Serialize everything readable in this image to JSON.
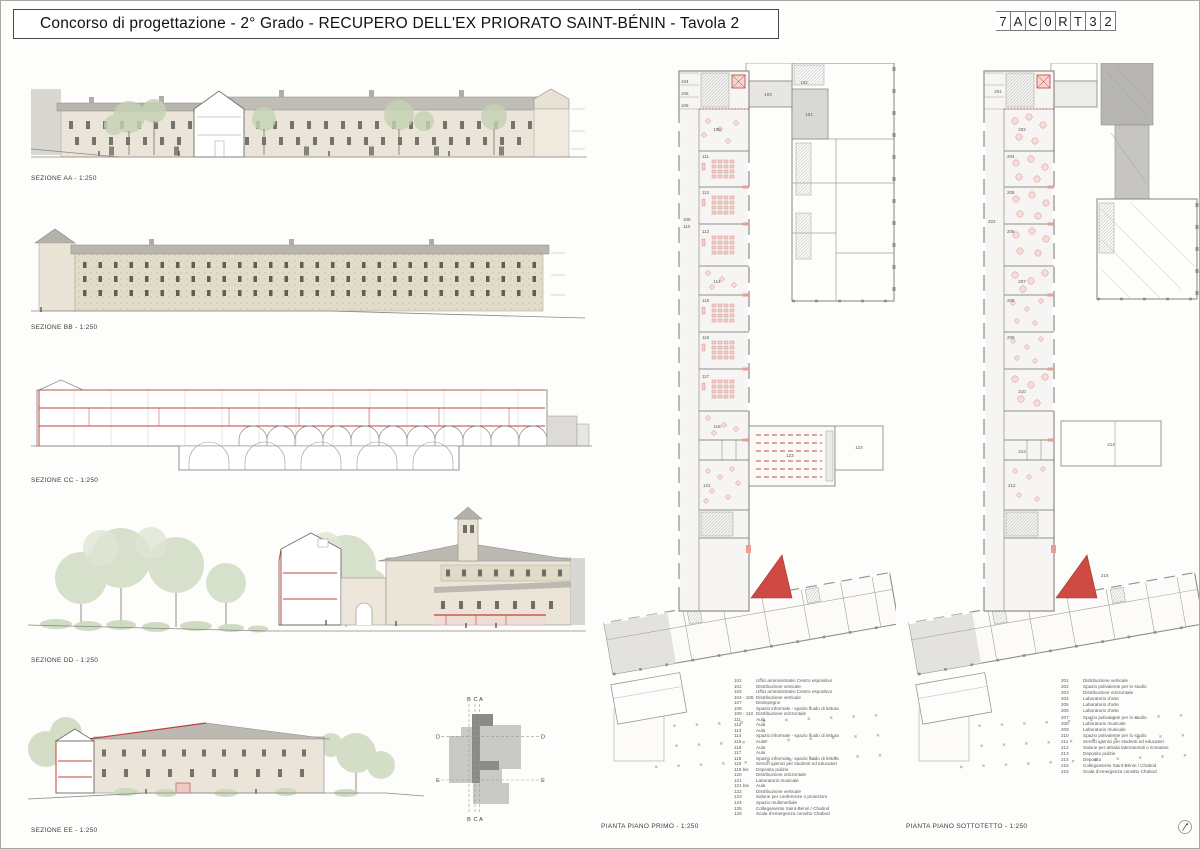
{
  "header": {
    "title": "Concorso di progettazione - 2° Grado - RECUPERO DELL'EX PRIORATO SAINT-BÉNIN - Tavola 2",
    "code_cells": [
      "7",
      "A",
      "C",
      "0",
      "R",
      "T",
      "3",
      "2"
    ]
  },
  "sections": [
    {
      "id": "AA",
      "label": "SEZIONE AA - 1:250"
    },
    {
      "id": "BB",
      "label": "SEZIONE BB - 1:250"
    },
    {
      "id": "CC",
      "label": "SEZIONE CC - 1:250"
    },
    {
      "id": "DD",
      "label": "SEZIONE DD - 1:250"
    },
    {
      "id": "EE",
      "label": "SEZIONE EE - 1:250"
    }
  ],
  "plans": [
    {
      "label": "PIANTA PIANO PRIMO - 1:250",
      "rooms": {
        "r101": "101",
        "r102": "102",
        "r103": "103",
        "r104": "104",
        "r105": "105",
        "r106": "106",
        "r108": "108",
        "r109": "109",
        "r110": "110",
        "r111": "111",
        "r112": "112",
        "r113": "113",
        "r114": "114",
        "r115": "115",
        "r116": "116",
        "r117": "117",
        "r118": "118",
        "r121": "121",
        "r123": "123",
        "r124": "124"
      }
    },
    {
      "label": "PIANTA PIANO SOTTOTETTO - 1:250",
      "rooms": {
        "r201": "201",
        "r202": "202",
        "r203": "203",
        "r204": "204",
        "r205": "205",
        "r206": "206",
        "r207": "207",
        "r208": "208",
        "r209": "209",
        "r210": "210",
        "r212": "212",
        "r213": "213",
        "r214": "214",
        "r215": "215"
      }
    }
  ],
  "key_plan": {
    "top_labels": [
      "B",
      "C",
      "A"
    ],
    "bottom_labels": [
      "B",
      "C",
      "A"
    ],
    "side_labels": {
      "d_left": "D",
      "d_right": "D",
      "e_left": "E",
      "e_right": "E"
    }
  },
  "legend_piano_primo": {
    "items": [
      {
        "code": "101",
        "label": "Uffici amministrativi Centro espositivo"
      },
      {
        "code": "102",
        "label": "Distribuzione verticale"
      },
      {
        "code": "103",
        "label": "Uffici amministrativi Centro espositivo"
      },
      {
        "code": "104 - 106",
        "label": "Distribuzione verticale"
      },
      {
        "code": "107",
        "label": "Disimpegno"
      },
      {
        "code": "108",
        "label": "Spazio informale - spazio fluido di lettura"
      },
      {
        "code": "109 - 110",
        "label": "Distribuzione orizzontale"
      },
      {
        "code": "111",
        "label": "Aula"
      },
      {
        "code": "112",
        "label": "Aula"
      },
      {
        "code": "113",
        "label": "Aula"
      },
      {
        "code": "114",
        "label": "Spazio informale - spazio fluido di lettura"
      },
      {
        "code": "115",
        "label": "Aula"
      },
      {
        "code": "116",
        "label": "Aula"
      },
      {
        "code": "117",
        "label": "Aula"
      },
      {
        "code": "118",
        "label": "Spazio informale - spazio fluido di lettura"
      },
      {
        "code": "119",
        "label": "Servizi igienici per studenti ed educatori"
      },
      {
        "code": "119 bis",
        "label": "Deposito pulizie"
      },
      {
        "code": "120",
        "label": "Distribuzione orizzontale"
      },
      {
        "code": "121",
        "label": "Laboratorio musicale"
      },
      {
        "code": "121 bis",
        "label": "Aula"
      },
      {
        "code": "122",
        "label": "Distribuzione verticale"
      },
      {
        "code": "123",
        "label": "Salone per conferenze o proiezioni"
      },
      {
        "code": "124",
        "label": "Spazio multimediale"
      },
      {
        "code": "125",
        "label": "Collegamento Saint-Bénin / Chabod"
      },
      {
        "code": "126",
        "label": "Scala d'emergenza convitto Chabod"
      }
    ]
  },
  "legend_sottotetto": {
    "items": [
      {
        "code": "201",
        "label": "Distribuzione verticale"
      },
      {
        "code": "202",
        "label": "Spazio polivalente per lo studio"
      },
      {
        "code": "203",
        "label": "Distribuzione orizzontale"
      },
      {
        "code": "204",
        "label": "Laboratorio d'arte"
      },
      {
        "code": "205",
        "label": "Laboratorio d'arte"
      },
      {
        "code": "206",
        "label": "Laboratorio d'arte"
      },
      {
        "code": "207",
        "label": "Spazio polivalente per lo studio"
      },
      {
        "code": "208",
        "label": "Laboratorio musicale"
      },
      {
        "code": "209",
        "label": "Laboratorio musicale"
      },
      {
        "code": "210",
        "label": "Spazio polivalente per lo studio"
      },
      {
        "code": "211",
        "label": "Servizi igienici per studenti ed educatori"
      },
      {
        "code": "212",
        "label": "Salone per attività laboratoriali  o ricreative"
      },
      {
        "code": "213",
        "label": "Deposito pulizie"
      },
      {
        "code": "214",
        "label": "Deposito"
      },
      {
        "code": "215",
        "label": "Collegamento Saint-Bénin / Chabod"
      },
      {
        "code": "216",
        "label": "Scala d'emergenza convitto Chabod"
      }
    ]
  },
  "colors": {
    "accent_red": "#c2403a",
    "furniture_pink": "#e9a9a2",
    "wall_beige": "#e8e3d5",
    "roof_gray": "#b6b3ad",
    "tree_green": "#b9c9a8",
    "plan_wall_gray": "#8f8e8a",
    "shaded_room_gray": "#d8d8d5"
  }
}
